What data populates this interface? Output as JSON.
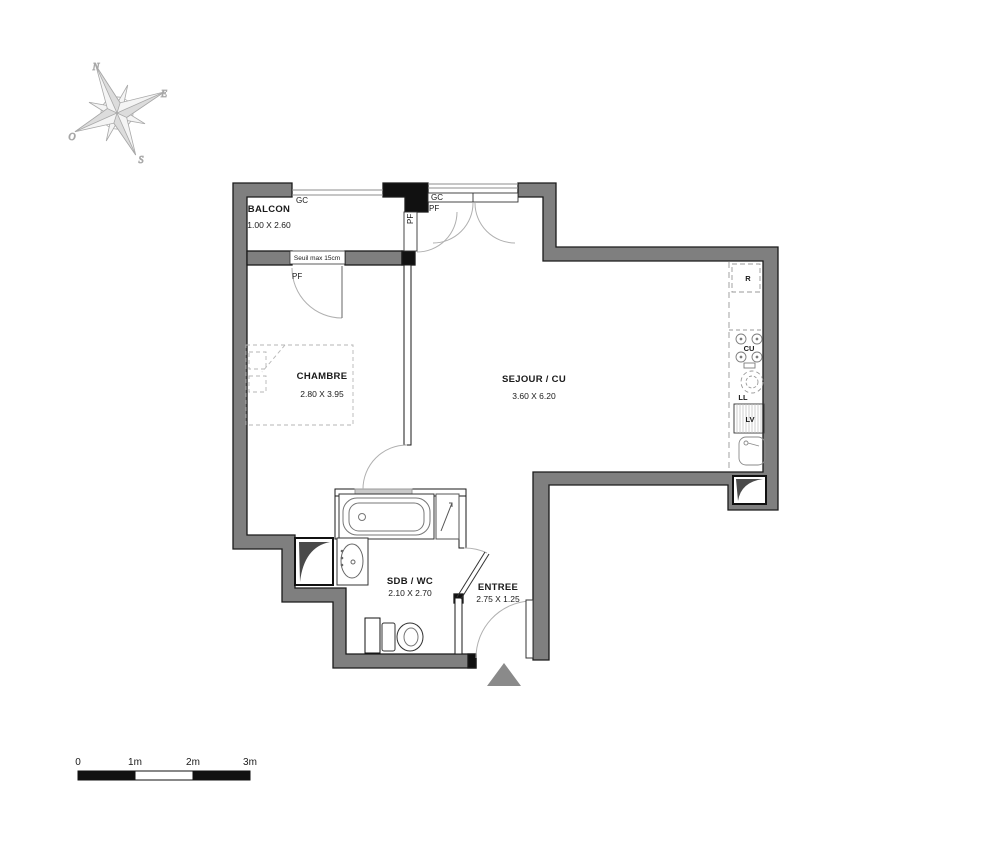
{
  "colors": {
    "wall_fill": "#7f7f7f",
    "wall_outline": "#1a1a1a",
    "door_arc": "#b0b0b0",
    "dashed_furniture": "#b5b5b5",
    "kitchen_dash": "#999999",
    "entrance_triangle": "#8a8a8a"
  },
  "compass": {
    "north": "N",
    "east": "E",
    "south": "S",
    "west": "O"
  },
  "rooms": [
    {
      "id": "balcon",
      "name": "BALCON",
      "dims": "1.00 X 2.60"
    },
    {
      "id": "chambre",
      "name": "CHAMBRE",
      "dims": "2.80 X 3.95"
    },
    {
      "id": "sejour",
      "name": "SEJOUR / CU",
      "dims": "3.60 X 6.20"
    },
    {
      "id": "sdb",
      "name": "SDB / WC",
      "dims": "2.10 X 2.70"
    },
    {
      "id": "entree",
      "name": "ENTREE",
      "dims": "2.75 X 1.25"
    }
  ],
  "annotations": {
    "balcony_rail": "GC",
    "chambre_door_label": "PF",
    "balcony_door_label": "PF",
    "sejour_rail": "GC",
    "sejour_window_label": "PF",
    "threshold": "Seuil max 15cm"
  },
  "kitchen": {
    "fridge": "R",
    "hob": "CU",
    "washing_machine": "LL",
    "dishwasher": "LV"
  },
  "scale_bar": {
    "tick0": "0",
    "tick1": "1m",
    "tick2": "2m",
    "tick3": "3m"
  }
}
